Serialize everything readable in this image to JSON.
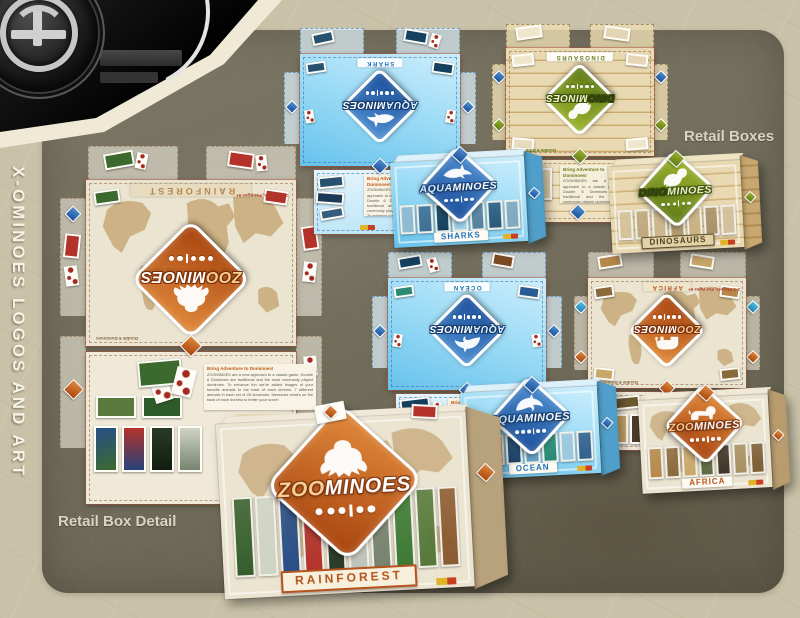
{
  "page": {
    "sidebar_title": "X-OMINOES LOGOS AND ART",
    "retail_boxes_label": "Retail Boxes",
    "retail_box_detail_label": "Retail Box Detail"
  },
  "brands": {
    "zoo": {
      "prefix": "ZOO",
      "suffix": "MINOES"
    },
    "aqua": {
      "prefix": "AQUA",
      "suffix": "MINOES"
    },
    "dino": {
      "prefix": "DINO",
      "suffix": "MINOES"
    }
  },
  "regions": {
    "rainforest": "RAINFOREST",
    "shark": "SHARK",
    "sharks": "SHARKS",
    "ocean": "OCEAN",
    "dinosaurs": "DINOSAURS",
    "africa": "AFRICA"
  },
  "text": {
    "blurb_title": "Bring Adventure to Dominoes!",
    "blurb_body": "ZOOMINOES are a new approach to a classic game. Double 6 Dominoes are traditional and the most commonly played dominoes. To enhance fun we've added images of your favorite animals to the back of each domino. 7 different animals in each set of 28 dominoes. Memorize what's on the back of each domino to better your score!",
    "includes_title": "Includes:",
    "includes_body": "28 large dominoes & storage box",
    "includes_more": "Check out our other games!",
    "players": "2-4 Players, For Ages 6+",
    "edition": "Double 6 Dominoes"
  },
  "colors": {
    "zoo_accent": "#b5521d",
    "aqua_accent": "#1d6fb5",
    "dino_accent": "#6b7d20"
  },
  "palettes": {
    "rainforest": [
      "#355e2c",
      "#cfd4c2",
      "#274e86",
      "#b3332a",
      "#2a3a28",
      "#bfc4ba",
      "#77836f",
      "#3c7a33",
      "#56793a",
      "#8a5a30"
    ],
    "sharks": [
      "#8fb9d2",
      "#3f6f96",
      "#16405f",
      "#9fd0e8",
      "#56829f",
      "#2a5a7e",
      "#7fa8c0"
    ],
    "ocean": [
      "#2a5d96",
      "#c06a2a",
      "#1f4368",
      "#63a0c8",
      "#2a8a74",
      "#9cc8e0",
      "#33608e"
    ],
    "dinosaurs": [
      "#d5c29a",
      "#bfa87e",
      "#cbb78e",
      "#b09a72",
      "#c9b184",
      "#a8916a",
      "#d2c09c"
    ],
    "africa": [
      "#b5884a",
      "#8a6a3a",
      "#c9a86a",
      "#5f6b42",
      "#3f3428",
      "#a89060",
      "#7d5f35"
    ]
  }
}
